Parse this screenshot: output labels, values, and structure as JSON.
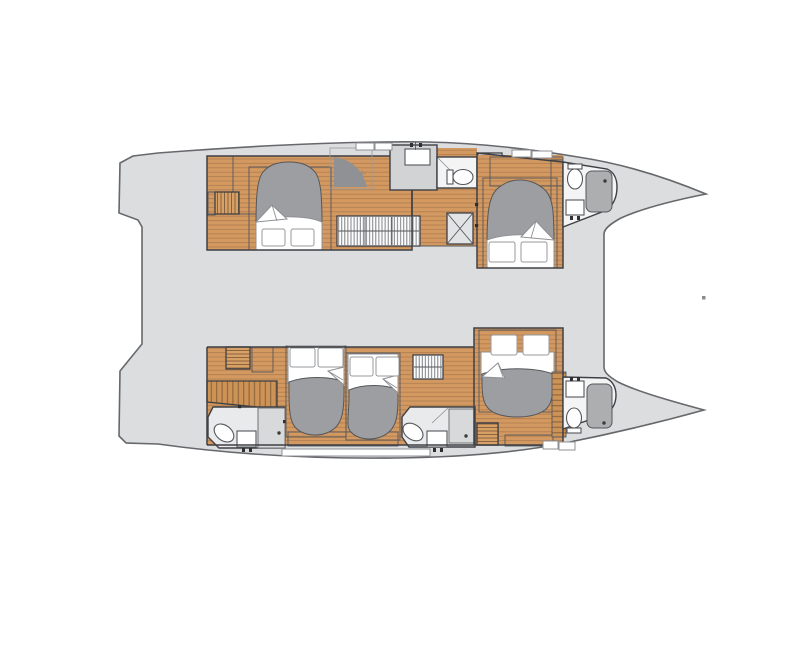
{
  "diagram": {
    "subject": "catamaran-interior-floor-plan",
    "view": "overhead-plan-view",
    "colors": {
      "background": "#ffffff",
      "deck": "#dcddde",
      "hull_outline": "#66686c",
      "wall": "#3e4045",
      "wood": "#d49961",
      "wood_line": "#a97a4d",
      "cabinet": "#dfa66f",
      "duvet": "#9c9ea1",
      "linen": "#ffffff",
      "counter_gray": "#d2d3d5",
      "bath_floor": "#e9eaeb",
      "bath_floor_light": "#f4f4f5",
      "shower": "#acaeb0",
      "companionway_dark": "#8f9194",
      "slat": "#6e5334",
      "hanger": "#73757a",
      "deck_fitting": "#8a8c8f"
    },
    "hulls": {
      "port": {
        "name": "port-hull",
        "rooms": [
          "aft-cabin",
          "companionway",
          "mid-bathroom",
          "forward-cabin",
          "bow-bathroom"
        ]
      },
      "starboard": {
        "name": "starboard-hull",
        "rooms": [
          "aft-bathroom",
          "aft-cabin",
          "mid-cabin",
          "mid-bathroom",
          "forward-cabin",
          "bow-bathroom"
        ]
      }
    },
    "fixtures": [
      "double-bed",
      "pillows",
      "duvet",
      "toilet",
      "sink-with-faucet",
      "shower-pad",
      "shower-drain",
      "stairs",
      "hanging-wardrobe",
      "louver-locker",
      "deck-hatch",
      "escape-hatch",
      "companionway-steps"
    ]
  }
}
